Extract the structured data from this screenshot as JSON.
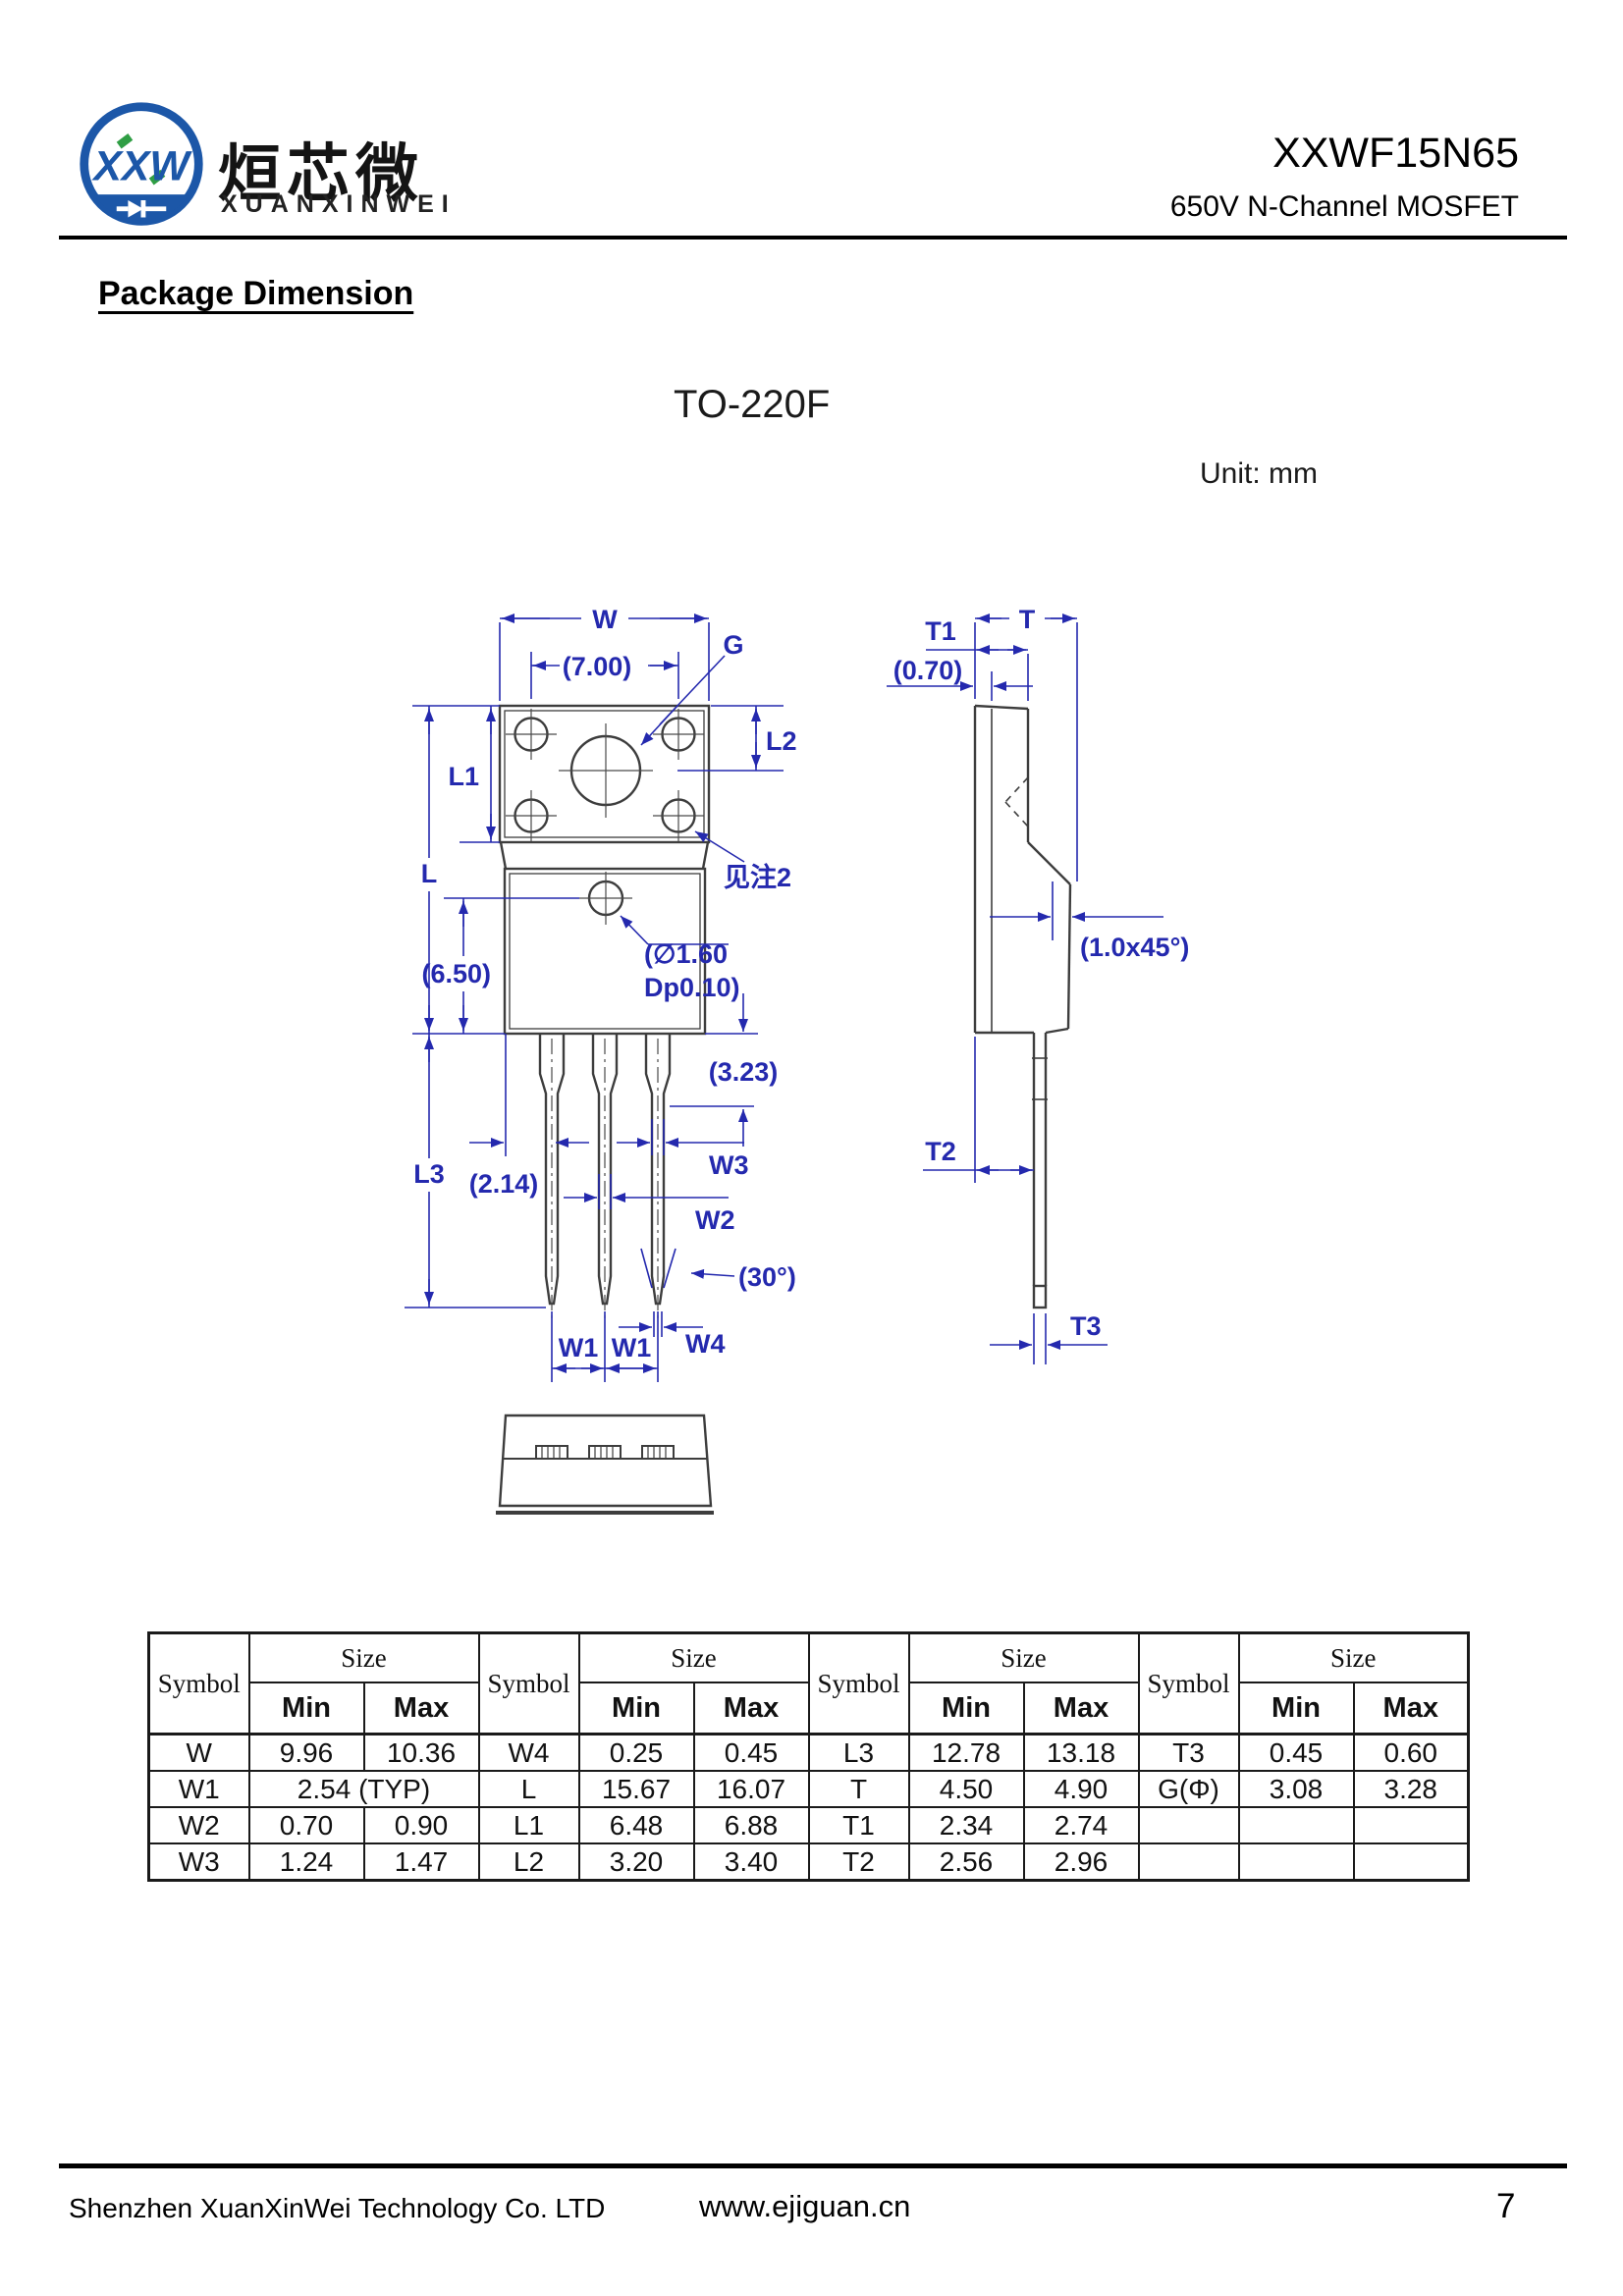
{
  "header": {
    "logo": {
      "monogram": "XXW",
      "cjk_name": "烜芯微",
      "latin_name": "XUANXINWEI"
    },
    "part_number": "XXWF15N65",
    "part_subtitle": "650V N-Channel MOSFET"
  },
  "section_title": "Package Dimension",
  "package_name": "TO-220F",
  "unit_note": "Unit: mm",
  "drawing": {
    "labels": {
      "w": "W",
      "d700": "(7.00)",
      "g": "G",
      "l2": "L2",
      "l1": "L1",
      "l": "L",
      "note2": "见注2",
      "d650": "(6.50)",
      "hole_line1": "(∅1.60",
      "hole_line2": "Dp0.10)",
      "d323": "(3.23)",
      "w3": "W3",
      "w2": "W2",
      "d214": "(2.14)",
      "l3": "L3",
      "deg30": "(30°)",
      "w1_a": "W1",
      "w1_b": "W1",
      "w4": "W4",
      "t1": "T1",
      "d070": "(0.70)",
      "t": "T",
      "chamfer": "(1.0x45°)",
      "t2": "T2",
      "t3": "T3"
    }
  },
  "table": {
    "symbol_header": "Symbol",
    "size_header": "Size",
    "min_header": "Min",
    "max_header": "Max",
    "rows": [
      [
        {
          "s": "W",
          "min": "9.96",
          "max": "10.36"
        },
        {
          "s": "W4",
          "min": "0.25",
          "max": "0.45"
        },
        {
          "s": "L3",
          "min": "12.78",
          "max": "13.18"
        },
        {
          "s": "T3",
          "min": "0.45",
          "max": "0.60"
        }
      ],
      [
        {
          "s": "W1",
          "merged": "2.54 (TYP)"
        },
        {
          "s": "L",
          "min": "15.67",
          "max": "16.07"
        },
        {
          "s": "T",
          "min": "4.50",
          "max": "4.90"
        },
        {
          "s": "G(Φ)",
          "min": "3.08",
          "max": "3.28"
        }
      ],
      [
        {
          "s": "W2",
          "min": "0.70",
          "max": "0.90"
        },
        {
          "s": "L1",
          "min": "6.48",
          "max": "6.88"
        },
        {
          "s": "T1",
          "min": "2.34",
          "max": "2.74"
        },
        {
          "s": "",
          "min": "",
          "max": ""
        }
      ],
      [
        {
          "s": "W3",
          "min": "1.24",
          "max": "1.47"
        },
        {
          "s": "L2",
          "min": "3.20",
          "max": "3.40"
        },
        {
          "s": "T2",
          "min": "2.56",
          "max": "2.96"
        },
        {
          "s": "",
          "min": "",
          "max": ""
        }
      ]
    ]
  },
  "footer": {
    "company": "Shenzhen XuanXinWei Technology Co. LTD",
    "website": "www.ejiguan.cn",
    "page_number": "7"
  }
}
